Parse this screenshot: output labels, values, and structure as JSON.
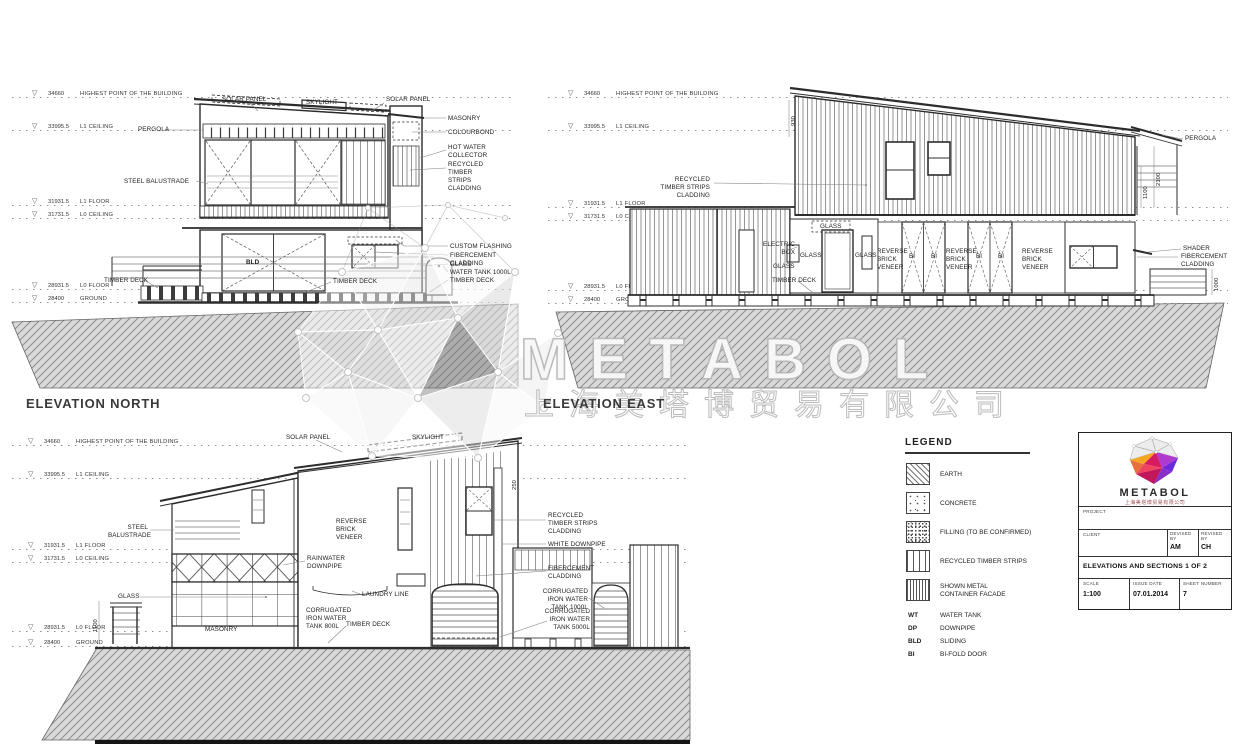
{
  "watermark": {
    "brand": "METABOL",
    "company": "上海美塔博贸易有限公司"
  },
  "levels": [
    {
      "value": "34660",
      "name": "HIGHEST POINT OF THE BUILDING"
    },
    {
      "value": "33995.5",
      "name": "L1 CEILING"
    },
    {
      "value": "31931.5",
      "name": "L1 FLOOR"
    },
    {
      "value": "31731.5",
      "name": "L0 CEILING"
    },
    {
      "value": "28931.5",
      "name": "L0 FLOOR"
    },
    {
      "value": "28400",
      "name": "GROUND"
    }
  ],
  "north": {
    "title": "ELEVATION NORTH",
    "labels": {
      "solar_panel": "SOLAR PANEL",
      "skylight": "SKYLIGHT",
      "pergola": "PERGOLA",
      "steel_balustrade": "STEEL BALUSTRADE",
      "masonry": "MASONRY",
      "colourbond": "COLOURBOND",
      "hot_water_collector": "HOT WATER COLLECTOR",
      "recycled_timber": "RECYCLED TIMBER STRIPS CLADDING",
      "custom_flashing": "CUSTOM FLASHING",
      "fibercement": "FIBERCEMENT CLADDING",
      "glass": "GLASS",
      "water_tank": "WATER TANK 1000L",
      "timber_deck": "TIMBER DECK",
      "sliding_mark": "BLD"
    }
  },
  "east": {
    "title": "ELEVATION EAST",
    "labels": {
      "recycled_timber": "RECYCLED TIMBER STRIPS CLADDING",
      "electric_box": "ELECTRIC BOX",
      "glass": "GLASS",
      "timber_deck": "TIMBER DECK",
      "reverse_brick": "REVERSE BRICK VENEER",
      "bifold_mark": "BI",
      "pergola": "PERGOLA",
      "shader": "SHADER",
      "fibercement": "FIBERCEMENT CLADDING",
      "dim_2100": "2100",
      "dim_1100": "1100",
      "dim_1000": "1000",
      "dim_930": "930"
    }
  },
  "section": {
    "labels": {
      "solar_panel": "SOLAR PANEL",
      "skylight": "SKYLIGHT",
      "steel_balustrade": "STEEL BALUSTRADE",
      "rainwater_downpipe": "RAINWATER DOWNPIPE",
      "glass": "GLASS",
      "masonry": "MASONRY",
      "laundry_line": "LAUNDRY LINE",
      "reverse_brick": "REVERSE BRICK VENEER",
      "recycled_timber": "RECYCLED TIMBER STRIPS CLADDING",
      "white_downpipe": "WHITE DOWNPIPE",
      "fibercement": "FIBERCEMENT CLADDING",
      "water_tank_800": "CORRUGATED IRON WATER TANK 800L",
      "water_tank_1000": "CORRUGATED IRON WATER TANK 1000L",
      "water_tank_5000": "CORRUGATED IRON WATER TANK 5000L",
      "timber_deck": "TIMBER DECK",
      "dim_1100": "1100",
      "dim_250": "250"
    }
  },
  "legend": {
    "title": "LEGEND",
    "items": [
      {
        "label": "EARTH"
      },
      {
        "label": "CONCRETE"
      },
      {
        "label": "FILLING (TO BE CONFIRMED)"
      },
      {
        "label": "RECYCLED TIMBER STRIPS"
      },
      {
        "label": "SHOWN METAL CONTAINER FACADE"
      }
    ],
    "abbreviations": [
      {
        "abbr": "WT",
        "meaning": "WATER TANK"
      },
      {
        "abbr": "DP",
        "meaning": "DOWNPIPE"
      },
      {
        "abbr": "BLD",
        "meaning": "SLIDING"
      },
      {
        "abbr": "BI",
        "meaning": "BI-FOLD DOOR"
      }
    ]
  },
  "titleblock": {
    "brand": "METABOL",
    "company": "上海美塔博贸易有限公司",
    "project_label": "PROJECT",
    "client_label": "CLIENT",
    "devised_by_label": "DEVISED BY",
    "devised_by": "AM",
    "revised_by_label": "REVISED BY",
    "revised_by": "CH",
    "sheet_title": "ELEVATIONS AND SECTIONS 1 OF 2",
    "scale_label": "SCALE",
    "scale": "1:100",
    "issue_date_label": "ISSUE DATE",
    "issue_date": "07.01.2014",
    "sheet_number_label": "SHEET NUMBER",
    "sheet_number": "7"
  }
}
